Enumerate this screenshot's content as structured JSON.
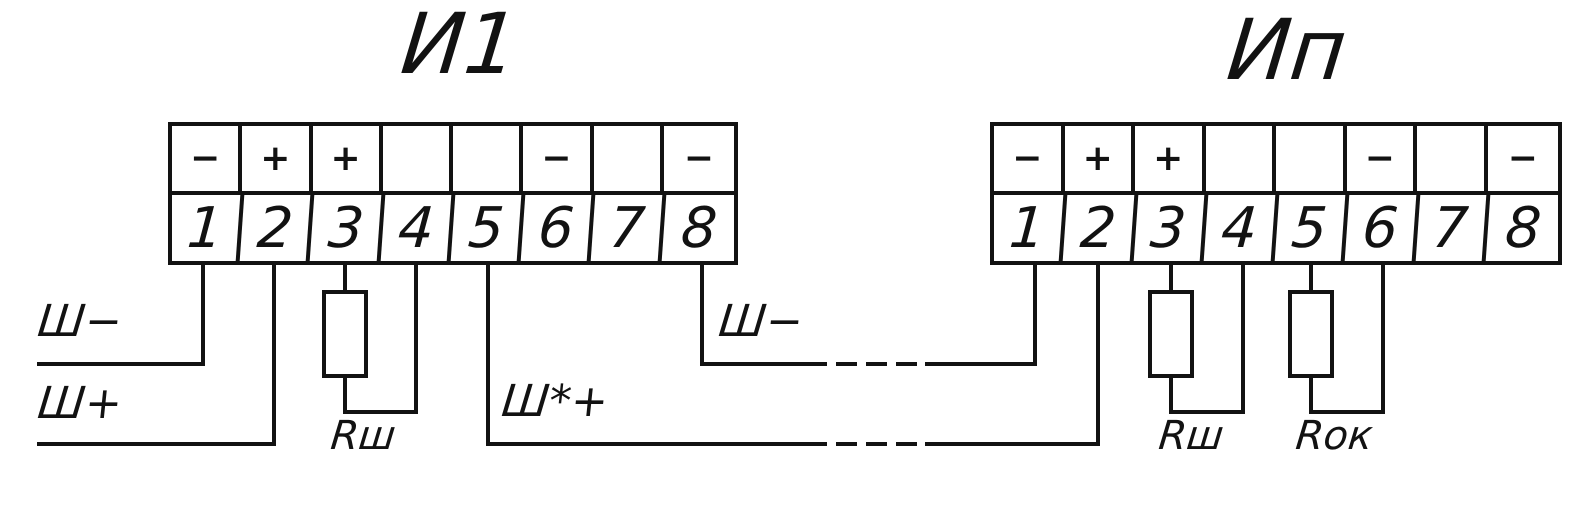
{
  "diagram": {
    "kind": "terminal-block wiring diagram",
    "background_color": "#ffffff",
    "line_color": "#121212"
  },
  "blocks": {
    "left": {
      "title": "И1",
      "signs": [
        "−",
        "+",
        "+",
        "",
        "",
        "−",
        "",
        "−"
      ],
      "numbers": [
        "1",
        "2",
        "3",
        "4",
        "5",
        "6",
        "7",
        "8"
      ]
    },
    "right": {
      "title": "Ип",
      "signs": [
        "−",
        "+",
        "+",
        "",
        "",
        "−",
        "",
        "−"
      ],
      "numbers": [
        "1",
        "2",
        "3",
        "4",
        "5",
        "6",
        "7",
        "8"
      ]
    }
  },
  "labels": {
    "shunt_minus_left": "Ш−",
    "shunt_plus_left": "Ш+",
    "shunt_star_plus": "Ш*+",
    "shunt_minus_mid": "Ш−",
    "r_shunt_left": "Rш",
    "r_shunt_right": "Rш",
    "r_ok": "Rок"
  }
}
